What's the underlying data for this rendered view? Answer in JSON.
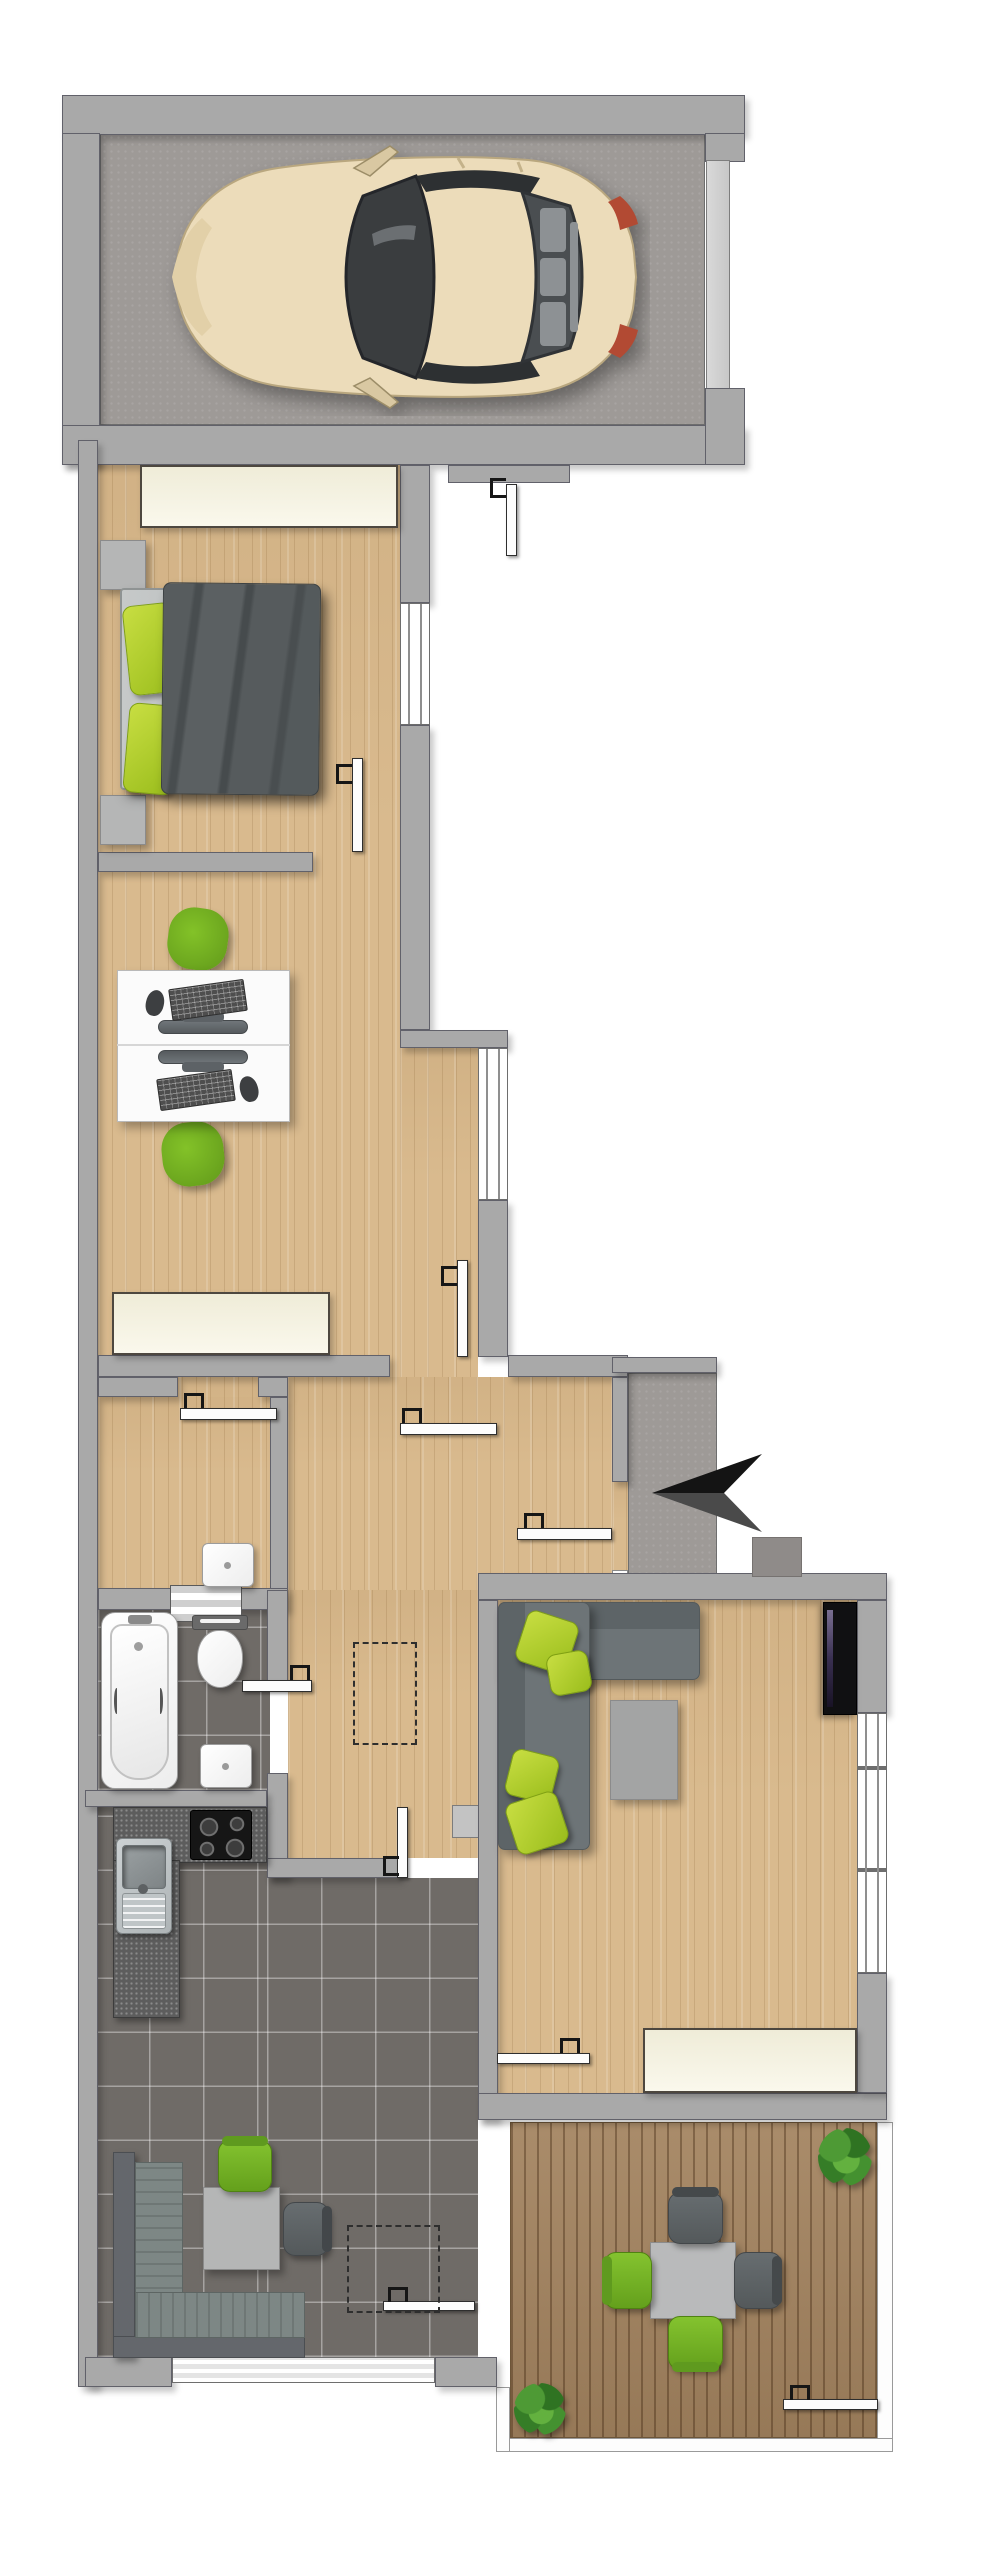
{
  "meta": {
    "title": "apartment-floor-plan",
    "image_type": "top-down architectural floor plan rendering",
    "canvas": {
      "width": 989,
      "height": 2560
    },
    "visible_text": "none"
  },
  "palette": {
    "wall_gray": "#a9a9a9",
    "wall_outline": "#61616a",
    "wood_floor": "#d9ba8e",
    "tile_floor": "#6f6b67",
    "concrete_floor": "#9e9a97",
    "terrace_deck": "#a3835f",
    "window_cream": "#f3f0dd",
    "accent_green": "#76b82a",
    "sofa_gray": "#6d7477",
    "duvet_gray": "#54595b",
    "counter_granite": "#5d5d5d",
    "car_body_champagne": "#ecdcba",
    "arrow_black": "#141414"
  },
  "rooms": [
    {
      "name": "garage",
      "floor": "concrete",
      "contents": [
        "car-top-view",
        "garage-door-right"
      ]
    },
    {
      "name": "bedroom",
      "floor": "wood",
      "contents": [
        "double-bed",
        "gray-duvet",
        "green-pillow",
        "green-pillow",
        "nightstand",
        "nightstand",
        "cream-window-top"
      ]
    },
    {
      "name": "office",
      "floor": "wood",
      "contents": [
        "desk",
        "desk",
        "monitor",
        "monitor",
        "keyboard",
        "keyboard",
        "mouse",
        "mouse",
        "green-swivel-chair",
        "green-swivel-chair",
        "cream-window-bottom"
      ]
    },
    {
      "name": "hallway",
      "floor": "wood",
      "contents": [
        "attic-hatch-dashed-outline",
        "open-doors"
      ]
    },
    {
      "name": "wc-storage",
      "floor": "wood",
      "contents": [
        "hand-basin",
        "striped-pass-through"
      ]
    },
    {
      "name": "bathroom",
      "floor": "tile",
      "contents": [
        "bathtub",
        "toilet",
        "hand-basin"
      ]
    },
    {
      "name": "kitchen-dining",
      "floor": "tile",
      "contents": [
        "l-shaped-granite-counter",
        "steel-sink-with-drainer",
        "cooktop-4-burners",
        "corner-bench",
        "dining-table",
        "green-chair",
        "gray-chair",
        "skylight-dashed-outline",
        "wide-window-bottom"
      ]
    },
    {
      "name": "living-room",
      "floor": "wood",
      "contents": [
        "corner-sofa",
        "green-cushion",
        "green-cushion",
        "green-cushion",
        "green-cushion",
        "coffee-table",
        "wall-tv-panel",
        "cream-window-bottom",
        "side-windows-right"
      ]
    },
    {
      "name": "entrance-porch",
      "floor": "concrete",
      "contents": [
        "entrance-arrow-left",
        "doormat"
      ]
    },
    {
      "name": "terrace",
      "floor": "deck",
      "contents": [
        "square-table",
        "green-chair",
        "green-chair",
        "gray-chair",
        "gray-chair",
        "potted-plant",
        "potted-plant",
        "white-railing-border",
        "gate-leaf"
      ]
    }
  ],
  "counts": {
    "door-leaves": 11,
    "cream-windows": 3,
    "glass-window-strips": 4,
    "plants": 2,
    "green-chairs": 5,
    "dashed-outlines": 2
  },
  "icons": [
    {
      "name": "entrance-arrow-icon",
      "meaning": "entrance direction, points left toward entry door",
      "color": "#141414"
    },
    {
      "name": "door-hinge-icon",
      "meaning": "door handle/hinge symbol on every door leaf",
      "color": "#161616"
    }
  ]
}
